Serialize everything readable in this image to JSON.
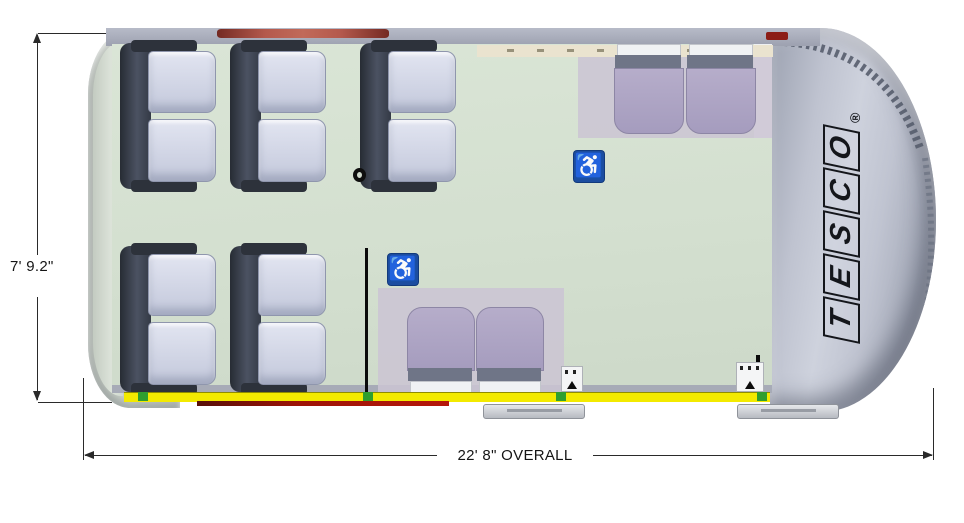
{
  "diagram_type": "bus-floor-plan-top-view",
  "dims": {
    "height_label": "7' 9.2\"",
    "length_label": "22' 8\" OVERALL"
  },
  "branding": {
    "letters": [
      "T",
      "E",
      "S",
      "C",
      "O"
    ],
    "registered": "®"
  },
  "icons": {
    "wheelchair": "♿"
  },
  "layout_counts": {
    "double_passenger_seats": 5,
    "flip_seats": 4,
    "wheelchair_positions": 2,
    "tiedown_markers": 4
  },
  "colors": {
    "floor_green": "#d5e0d1",
    "body_gray": "#bfc3d0",
    "seat_lavender": "#c9cedf",
    "seat_frame_dark": "#3a404c",
    "flip_seat_purple": "#aaa1c2",
    "track_yellow": "#f3ea00",
    "door_red": "#9d1407",
    "roof_red": "#b4594d",
    "sign_blue": "#1c4da0",
    "marker_green": "#2f9e2f"
  }
}
